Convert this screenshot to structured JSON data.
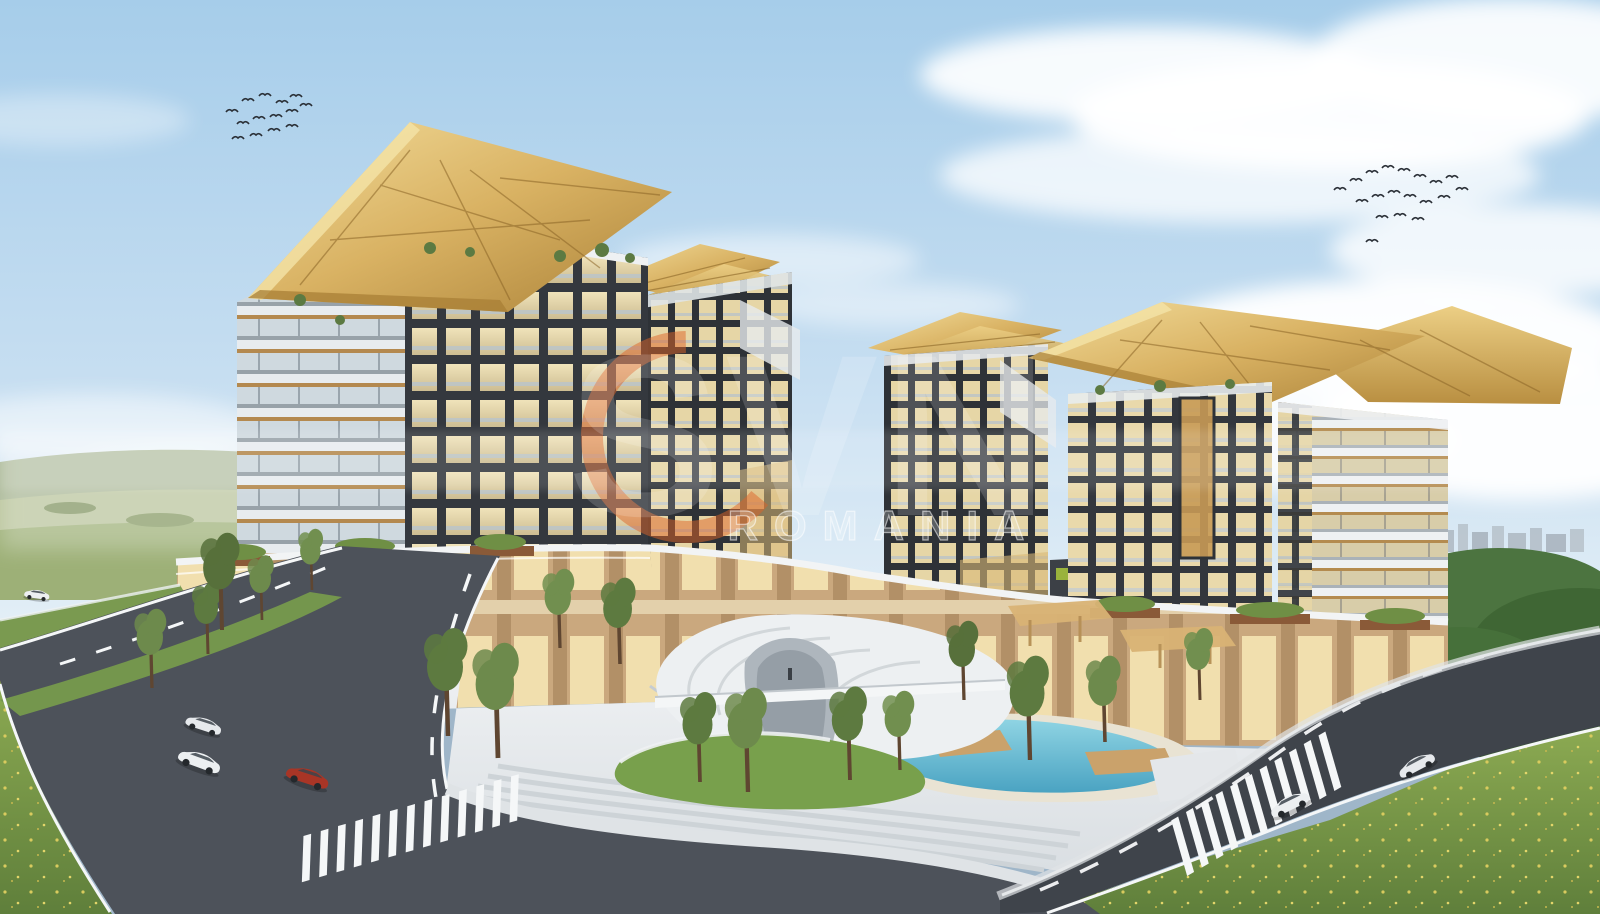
{
  "watermark": {
    "logo_text": "SVN",
    "region_text": "ROMANIA",
    "ring_color": "#dd6327",
    "text_color": "#ffffff"
  },
  "scene": {
    "description": "Aerial architectural rendering of a mixed-use residential complex: five towers with dark grid facades and golden cantilevered canopy roofs over a warm wood-slat retail podium, central plaza with white sculptural pavilion, amphitheater steps and turquoise pool, curved roads with cars and crosswalks, green hills and a distant city on the horizon, two flocks of birds in a blue sky with clouds.",
    "counts": {
      "towers": 5,
      "gold_canopies": 4,
      "cars": 6,
      "bird_flocks": 2,
      "crosswalks": 2
    },
    "palette": {
      "sky_top": "#a6cdea",
      "sky_horizon": "#e9f2f8",
      "cloud_white": "#ffffff",
      "gold_canopy": "#d9b263",
      "gold_canopy_shadow": "#a87f35",
      "facade_dark": "#34383e",
      "window_glow": "#ecdfb4",
      "balcony_white": "#e8ecef",
      "podium_wood": "#cdab7e",
      "plaza_white": "#e7eaec",
      "pool_turquoise": "#5fb9d2",
      "asphalt": "#474c52",
      "road_marking": "#f5f7f8",
      "grass_green": "#74964d",
      "meadow_green": "#7d9a49",
      "forest_green": "#46703a",
      "hills_haze": "#b3c09c",
      "corten_brown": "#96572f",
      "car_red": "#a83526",
      "car_white": "#eceff1",
      "bird_dark": "#2a2f36"
    }
  }
}
